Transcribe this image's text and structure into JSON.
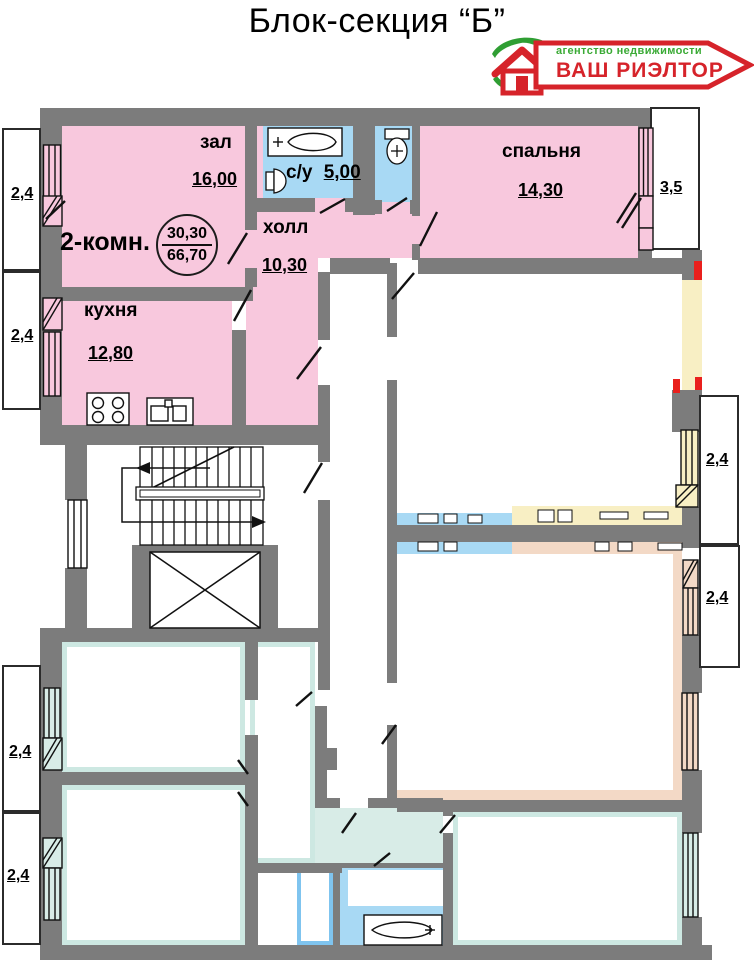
{
  "title": "Блок-секция “Б”",
  "logo": {
    "tagline": "агентство недвижимости",
    "name": "ВАШ РИЭЛТОР"
  },
  "apartment": {
    "type_label": "2-комн.",
    "area_living": "30,30",
    "area_total": "66,70",
    "rooms": [
      {
        "name": "зал",
        "area": "16,00"
      },
      {
        "name": "с/у",
        "area": "5,00"
      },
      {
        "name": "спальня",
        "area": "14,30"
      },
      {
        "name": "холл",
        "area": "10,30"
      },
      {
        "name": "кухня",
        "area": "12,80"
      }
    ]
  },
  "balconies": {
    "left_top": [
      "2,4",
      "2,4"
    ],
    "left_bottom": [
      "2,4",
      "2,4"
    ],
    "right_top": "3,5",
    "right_middle": [
      "2,4",
      "2,4"
    ]
  },
  "colors": {
    "featured_apartment": "#f8c8dd",
    "wet_rooms": "#a8d9f4",
    "walls": "#7c7c7c",
    "accent_red": "#d6232a",
    "accent_green": "#2f9e33"
  }
}
